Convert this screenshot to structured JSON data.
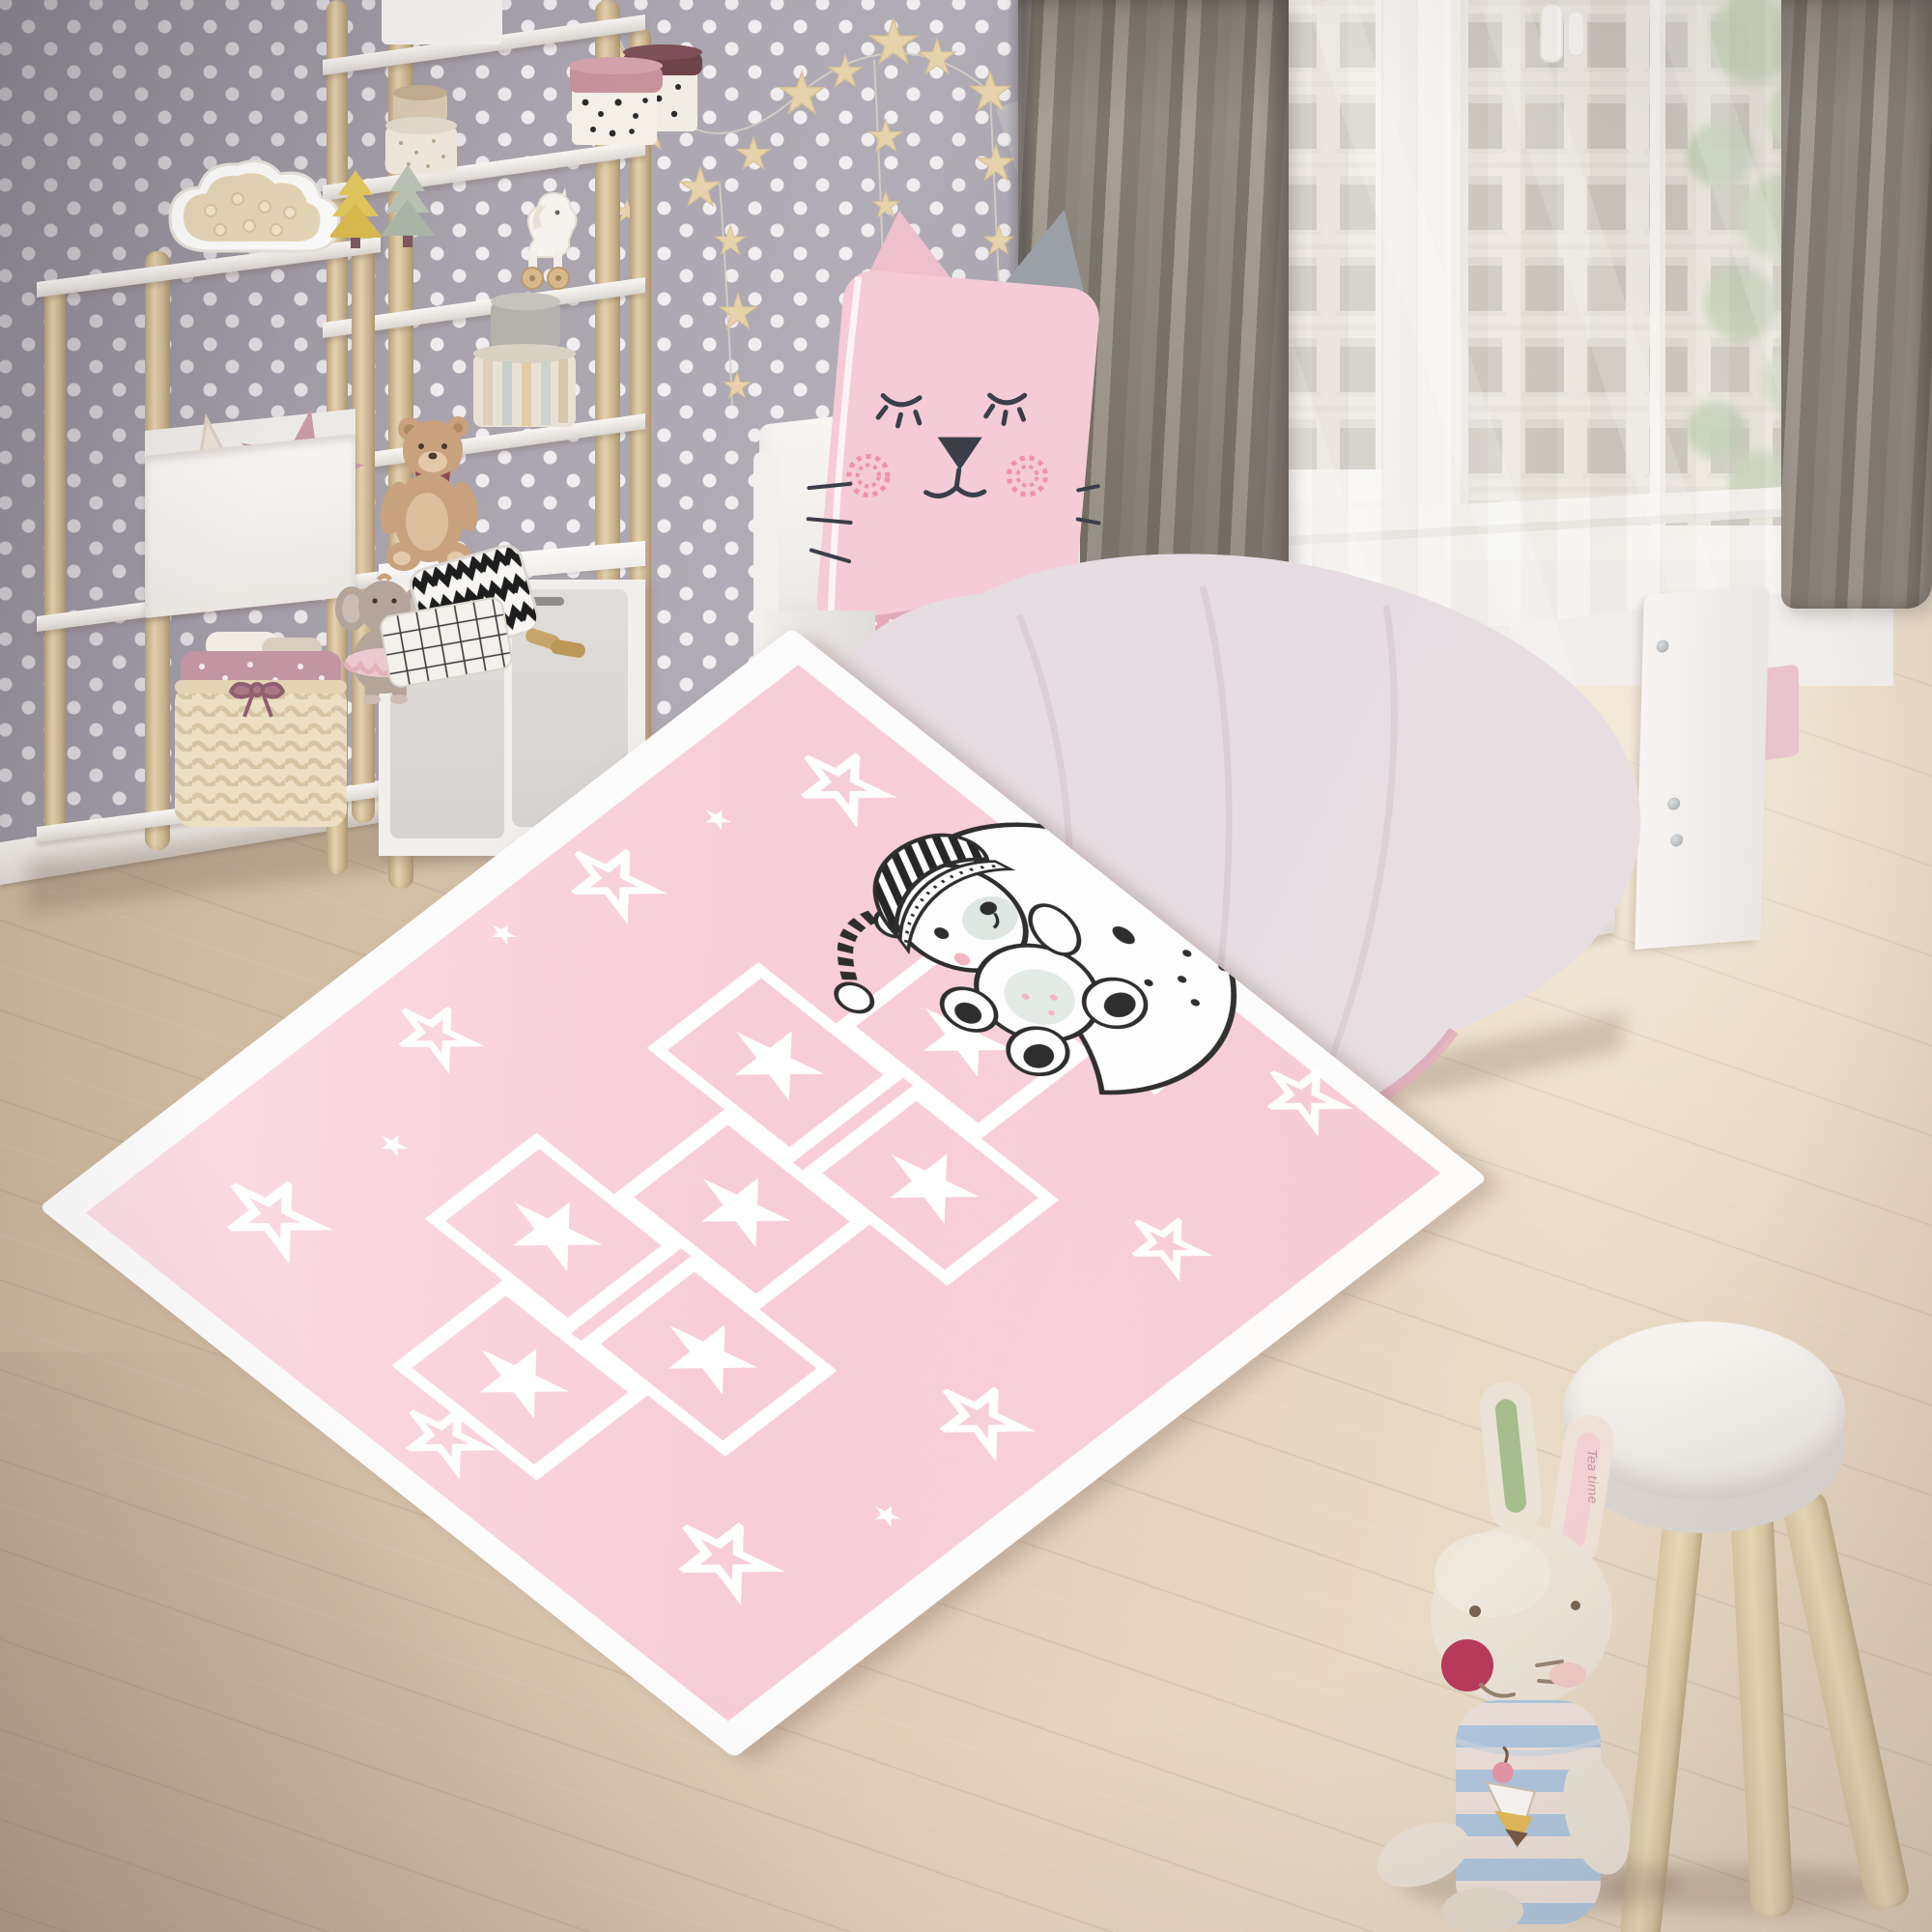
{
  "meta": {
    "domain": "natural-image",
    "description": "Rendered photo of a pastel children's bedroom with a pink hopscotch play rug, white day bed, polka-dot wallpaper, ladder shelves with toys, windows with city view, a white stool and a bunny plush."
  },
  "scene": {
    "wall": {
      "style": "polka dot wallpaper",
      "base_color": "#a8a3ad",
      "dot_color": "#f0edef"
    },
    "floor": {
      "material": "light wood planks",
      "color": "#d9c6b0"
    },
    "objects": [
      {
        "name": "star-garland",
        "color": "#e6d3ac"
      },
      {
        "name": "ladder-shelf-short",
        "colors": [
          "#d9c49f",
          "#f5f3f0"
        ]
      },
      {
        "name": "ladder-shelf-tall",
        "colors": [
          "#d9c49f",
          "#f5f3f0"
        ]
      },
      {
        "name": "cloud-night-light",
        "colors": [
          "#ffffff",
          "#e7d7b8"
        ]
      },
      {
        "name": "wooden-trees",
        "colors": [
          "#e2c65c",
          "#b9c2b4"
        ]
      },
      {
        "name": "star-cushions",
        "colors": [
          "#eae0d2",
          "#c79aa6"
        ]
      },
      {
        "name": "wicker-basket",
        "colors": [
          "#ecdfc4",
          "#c295a3"
        ]
      },
      {
        "name": "round-storage-boxes",
        "colors": [
          "#efe9dd",
          "#c6939c",
          "#6e444b",
          "#b5b2ac"
        ]
      },
      {
        "name": "dalmatian-dot-boxes",
        "colors": [
          "#f4efe7",
          "#2c2c2c"
        ]
      },
      {
        "name": "unicorn-pull-toy",
        "color": "#f6f3ee"
      },
      {
        "name": "teddy-bear-plush",
        "color": "#c8a27c"
      },
      {
        "name": "elephant-plush-tutu",
        "colors": [
          "#b4a49a",
          "#ecc9cf"
        ]
      },
      {
        "name": "zigzag-cushion",
        "colors": [
          "#ffffff",
          "#1e1e1e"
        ]
      },
      {
        "name": "checkered-cushion",
        "colors": [
          "#f4f1ec",
          "#39383b"
        ]
      },
      {
        "name": "white-storage-cabinet",
        "color": "#f1efec"
      },
      {
        "name": "day-bed",
        "color": "#f5f2f0"
      },
      {
        "name": "cat-face-cushion",
        "colors": [
          "#f4cbd6",
          "#3a3f49",
          "#ee92a8"
        ]
      },
      {
        "name": "paw-print-duvet",
        "colors": [
          "#f2edf0",
          "#d794a8"
        ]
      },
      {
        "name": "pink-fitted-sheet",
        "color": "#e2abba"
      },
      {
        "name": "under-bed-drawers",
        "color": "#f0edeb"
      },
      {
        "name": "grey-curtains",
        "color": "#8e887f"
      },
      {
        "name": "sheer-curtain",
        "color": "#f6f4f1"
      },
      {
        "name": "windows-city-view",
        "colors": [
          "#ddd6c9",
          "#989183"
        ]
      },
      {
        "name": "plant-foliage",
        "color": "#8fae77"
      },
      {
        "name": "white-stool",
        "colors": [
          "#f7f4f1",
          "#d6c29d"
        ]
      },
      {
        "name": "bunny-plush",
        "colors": [
          "#e9e1d4",
          "#a9c3dd",
          "#b2294d"
        ]
      }
    ]
  },
  "rug": {
    "style": "hopscotch play rug",
    "base_color": "#f7cdd7",
    "pattern_color": "#ffffff",
    "hopscotch_squares": 7,
    "motif": "teddy bear in striped nightcap sleeping on crescent moon",
    "decor": "white stars, outline stars, half-circle home arc"
  },
  "bunny": {
    "ear_text": "Tea time"
  }
}
